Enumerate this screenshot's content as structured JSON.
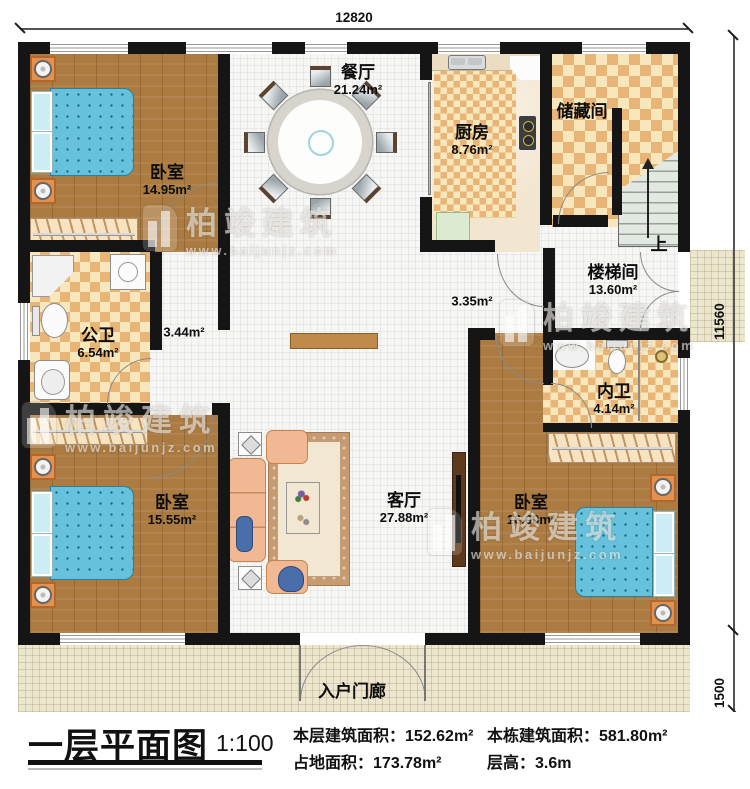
{
  "title_block": {
    "title": "一层平面图",
    "scale": "1:100"
  },
  "stats": [
    {
      "label": "本层建筑面积：",
      "value": "152.62m²"
    },
    {
      "label": "占地面积：",
      "value": "173.78m²"
    },
    {
      "label": "本栋建筑面积：",
      "value": "581.80m²"
    },
    {
      "label": "层高：",
      "value": "3.6m"
    }
  ],
  "dimensions": {
    "top": "12820",
    "right": "11560",
    "porch": "1500"
  },
  "rooms": {
    "bedroom1": {
      "name": "卧室",
      "area": "14.95m²"
    },
    "dining": {
      "name": "餐厅",
      "area": "21.24m²"
    },
    "kitchen": {
      "name": "厨房",
      "area": "8.76m²"
    },
    "storage": {
      "name": "储藏间"
    },
    "stairwell": {
      "name": "楼梯间",
      "area": "13.60m²"
    },
    "hall_left": {
      "area": "3.44m²"
    },
    "hall_center": {
      "area": "3.35m²"
    },
    "bath_public": {
      "name": "公卫",
      "area": "6.54m²"
    },
    "bath_private": {
      "name": "内卫",
      "area": "4.14m²"
    },
    "bedroom2": {
      "name": "卧室",
      "area": "15.55m²"
    },
    "living": {
      "name": "客厅",
      "area": "27.88m²"
    },
    "bedroom3": {
      "name": "卧室",
      "area": "16.00m²"
    },
    "porch": {
      "name": "入户门廊"
    }
  },
  "stairs": {
    "up": "上"
  },
  "watermark": {
    "brand": "柏竣建筑",
    "site": "www.baijunjz.com"
  },
  "colors": {
    "wall": "#151515",
    "wood": "#ab7b42",
    "bed": "#66c2dc",
    "checker_dark": "#e8b576",
    "checker_light": "#f8e7bd"
  }
}
